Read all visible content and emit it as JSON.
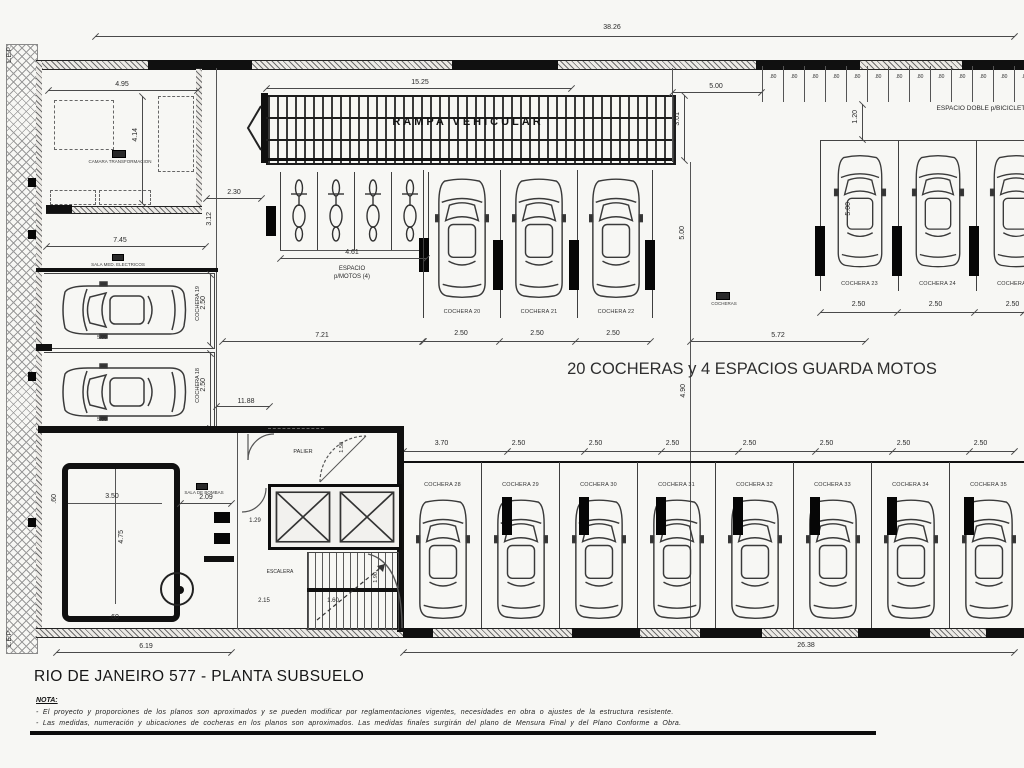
{
  "meta": {
    "plan_title": "RIO DE JANEIRO 577 - PLANTA SUBSUELO"
  },
  "notes": {
    "heading": "NOTA:",
    "lines": [
      "- El proyecto y proporciones de los planos son aproximados y se pueden modificar por reglamentaciones vigentes, necesidades en obra o ajustes de la estructura resistente.",
      "- Las medidas, numeración y ubicaciones de cocheras en los planos son aproximados. Las medidas finales surgirán del plano de Mensura Final y del Plano Conforme a Obra."
    ]
  },
  "annotations": {
    "summary": "20 COCHERAS y 4 ESPACIOS GUARDA MOTOS",
    "ramp": "RAMPA VEHICULAR",
    "moto_line1": "ESPACIO",
    "moto_line2": "p/MOTOS (4)",
    "bici": "ESPACIO DOBLE p/BICICLETAS",
    "camara": "CAMARA TRANSFORMACION",
    "sala_med": "SALA MED. ELECTRICOS",
    "sala_bombas": "SALA DE BOMBAS",
    "palier": "PALIER",
    "escalera": "ESCALERA",
    "cocheras_tag": "COCHERAS",
    "lep": "L.E.P."
  },
  "stalls": {
    "left": [
      "COCHERA 19",
      "COCHERA 18"
    ],
    "middle": [
      "COCHERA 20",
      "COCHERA 21",
      "COCHERA 22"
    ],
    "right_top": [
      "COCHERA 23",
      "COCHERA 24",
      "COCHERA 25"
    ],
    "bottom": [
      "COCHERA 28",
      "COCHERA 29",
      "COCHERA 30",
      "COCHERA 31",
      "COCHERA 32",
      "COCHERA 33",
      "COCHERA 34",
      "COCHERA 35"
    ]
  },
  "dims": {
    "total_top": "38.26",
    "total_bottom": "26.38",
    "ramp_len": "15.25",
    "ramp_w": "3.01",
    "gap": "5.00",
    "bici_depth": "1.20",
    "camara_w": "4.95",
    "camara_h": "4.14",
    "sala_w": "7.45",
    "pass_w": "2.30",
    "pass_h": "3.12",
    "moto_w": "4.61",
    "aisle1": "7.21",
    "aisle2": "5.72",
    "aisle_h": "4.90",
    "left_len": "11.88",
    "left_stall1": "2.50",
    "left_stall2": "2.50",
    "car_len1": "5.00",
    "car_len2": "5.00",
    "car_len_m": "5.00",
    "car_len_r": "5.00",
    "middle": [
      "2.50",
      "2.50",
      "2.50"
    ],
    "right_top": [
      "2.50",
      "2.50",
      "2.50"
    ],
    "bottom": [
      "3.70",
      "2.50",
      "2.50",
      "2.50",
      "2.50",
      "2.50",
      "2.50",
      "2.50"
    ],
    "bici": [
      ".80",
      ".80",
      ".80",
      ".80",
      ".80",
      ".80",
      ".80",
      ".80",
      ".80",
      ".80",
      ".80",
      ".80",
      ".80"
    ],
    "pump_w": "3.50",
    "pump_h": "4.75",
    "pump_m1": ".60",
    "pump_m2": ".60",
    "bombas_w": "2.09",
    "pump_total": "6.19",
    "stair_w1": "2.15",
    "stair_w2": "1.60",
    "stair_h": "1.90",
    "palier_d": "1.29",
    "door_r": "1.50"
  },
  "colors": {
    "ink": "#101010",
    "paper": "#f7f7f4"
  }
}
